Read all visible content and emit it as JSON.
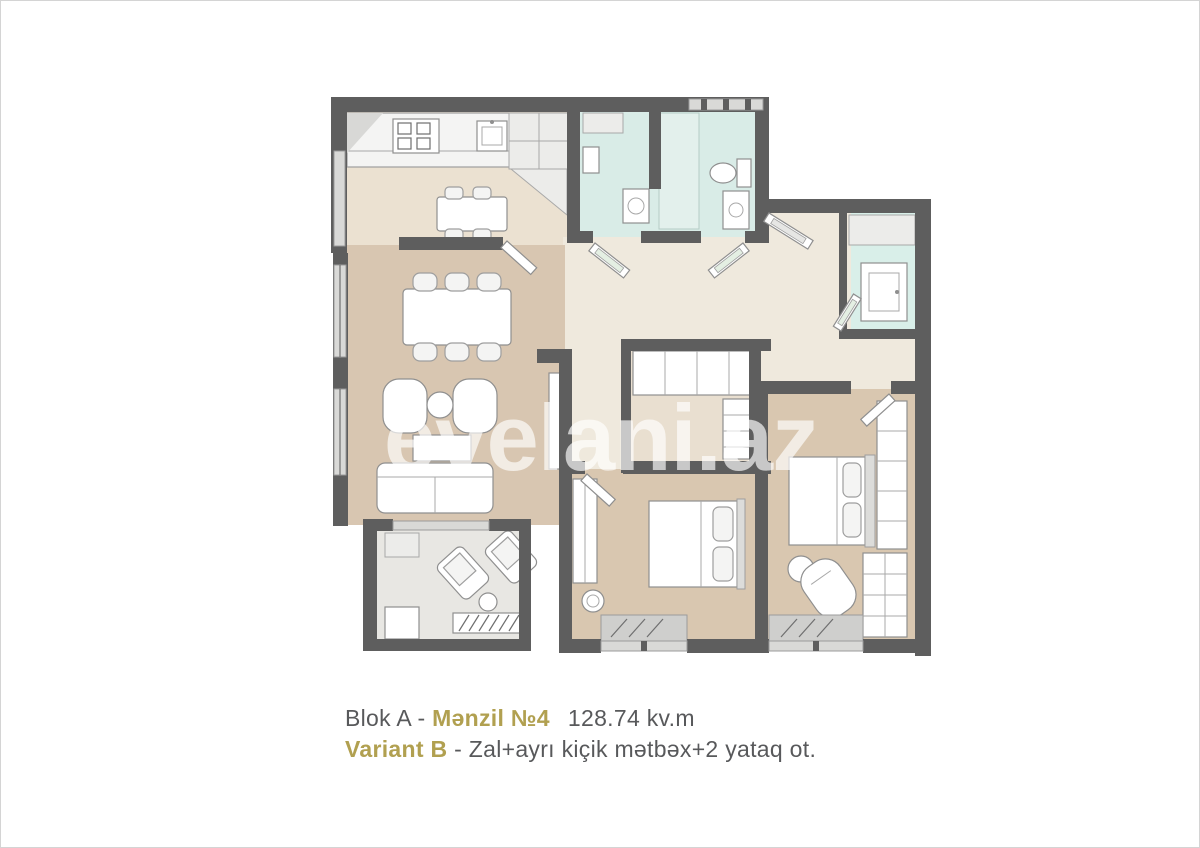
{
  "page": {
    "background": "#ffffff",
    "border_color": "#d4d4d4"
  },
  "watermark": {
    "text": "evelani.az"
  },
  "caption": {
    "block": "Blok A",
    "separator": " - ",
    "apartment": "Mənzil №4",
    "area": "128.74 kv.m",
    "variant": "Variant B",
    "variant_description": "Zal+ayrı kiçik mətbəx+2 yataq ot.",
    "text_color": "#58595b",
    "accent_color": "#b1a050"
  },
  "floorplan": {
    "wall_color": "#5e5e5e",
    "furniture_fill": "#f4f4f3",
    "furniture_stroke": "#9e9e9e",
    "rooms": {
      "kitchen": {
        "floor": "#ebe1d1"
      },
      "living_room": {
        "floor": "#d8c6b1"
      },
      "bathroom_1": {
        "floor": "#d9ece7"
      },
      "bathroom_2": {
        "floor": "#d9ece7"
      },
      "bathroom_3": {
        "floor": "#d9efe9"
      },
      "hallway": {
        "floor": "#efe9dd"
      },
      "wardrobe_room": {
        "floor": "#e9dfd0"
      },
      "bedroom_1": {
        "floor": "#d9c7b0"
      },
      "bedroom_2": {
        "floor": "#d9c7b0"
      },
      "balcony": {
        "floor": "#e8e7e3"
      }
    }
  }
}
